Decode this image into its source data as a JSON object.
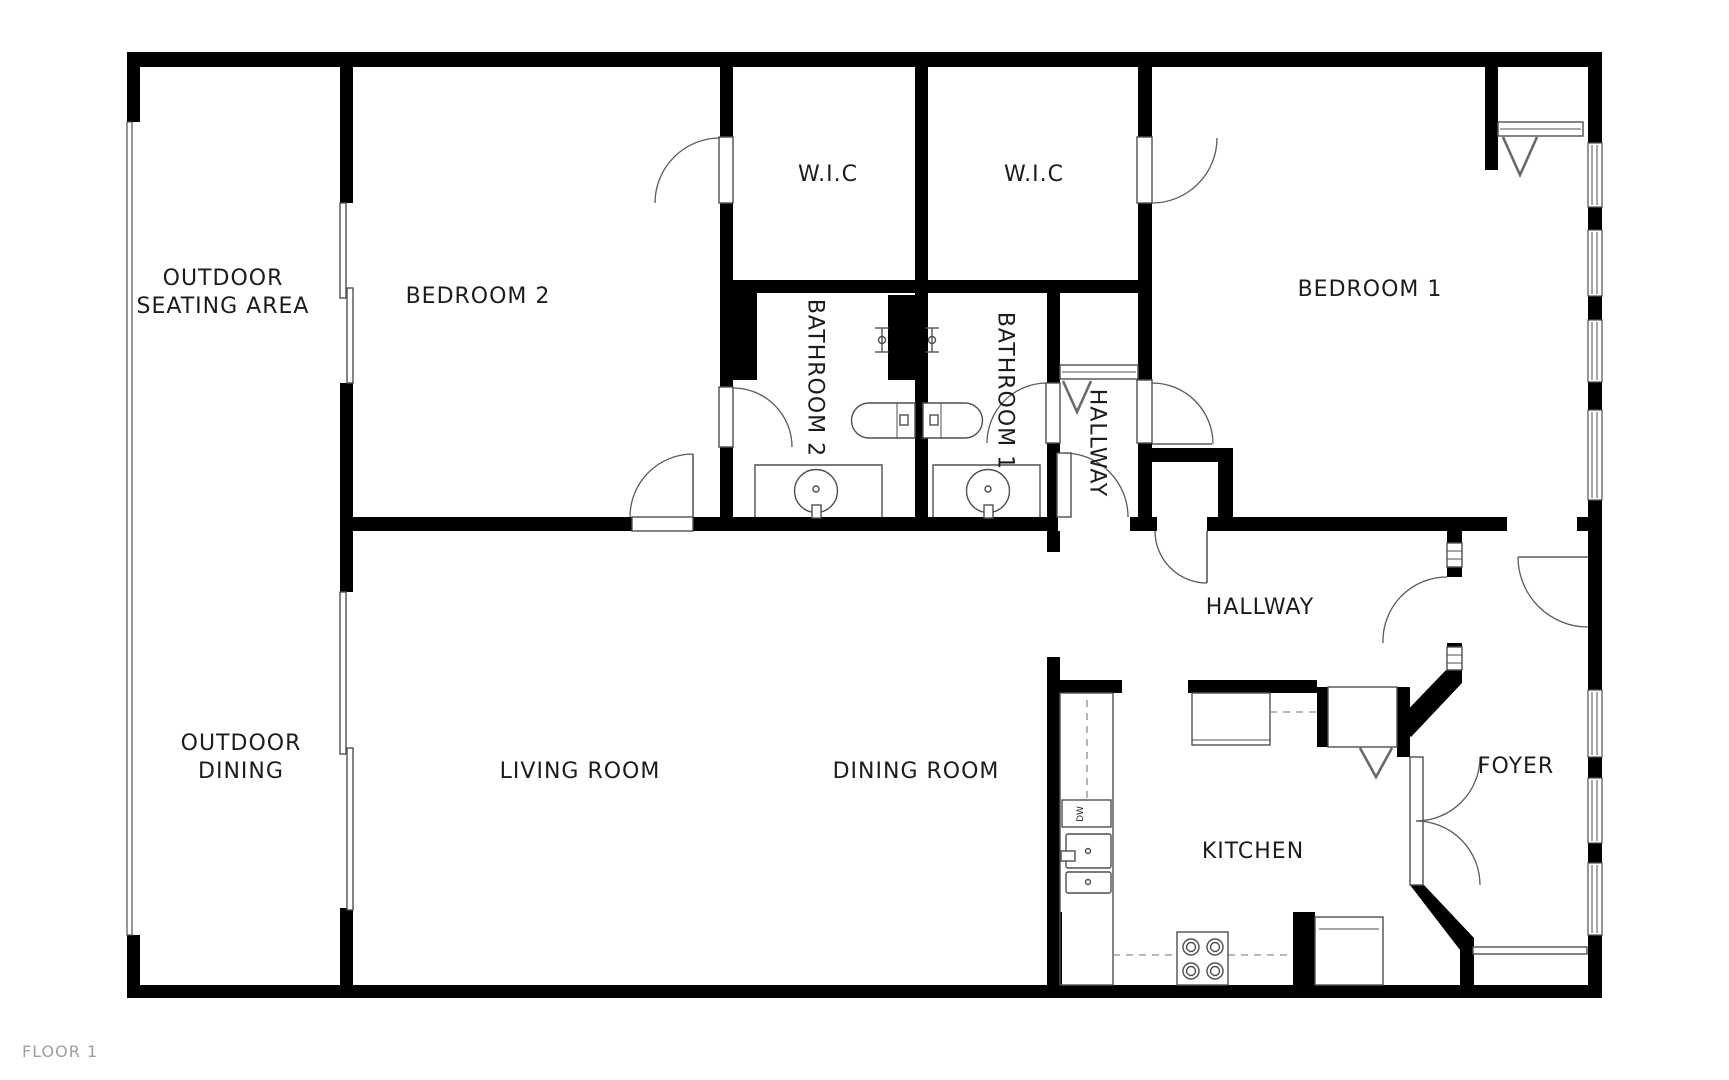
{
  "floorplan": {
    "colors": {
      "wall": "#000000",
      "fixture_line": "#4f4f4f",
      "label_text": "#1c1c1c",
      "floor_label_text": "#9e9e9e",
      "background": "#ffffff"
    },
    "labels": {
      "outdoor_seating_line1": "OUTDOOR",
      "outdoor_seating_line2": "SEATING AREA",
      "outdoor_dining_line1": "OUTDOOR",
      "outdoor_dining_line2": "DINING",
      "bedroom2": "BEDROOM 2",
      "bedroom1": "BEDROOM 1",
      "wic_left": "W.I.C",
      "wic_right": "W.I.C",
      "bathroom2": "BATHROOM 2",
      "bathroom1": "BATHROOM 1",
      "hallway_upper": "HALLWAY",
      "hallway_main": "HALLWAY",
      "living_room": "LIVING ROOM",
      "dining_room": "DINING ROOM",
      "kitchen": "KITCHEN",
      "foyer": "FOYER",
      "dishwasher": "DW",
      "floor": "FLOOR 1"
    }
  }
}
